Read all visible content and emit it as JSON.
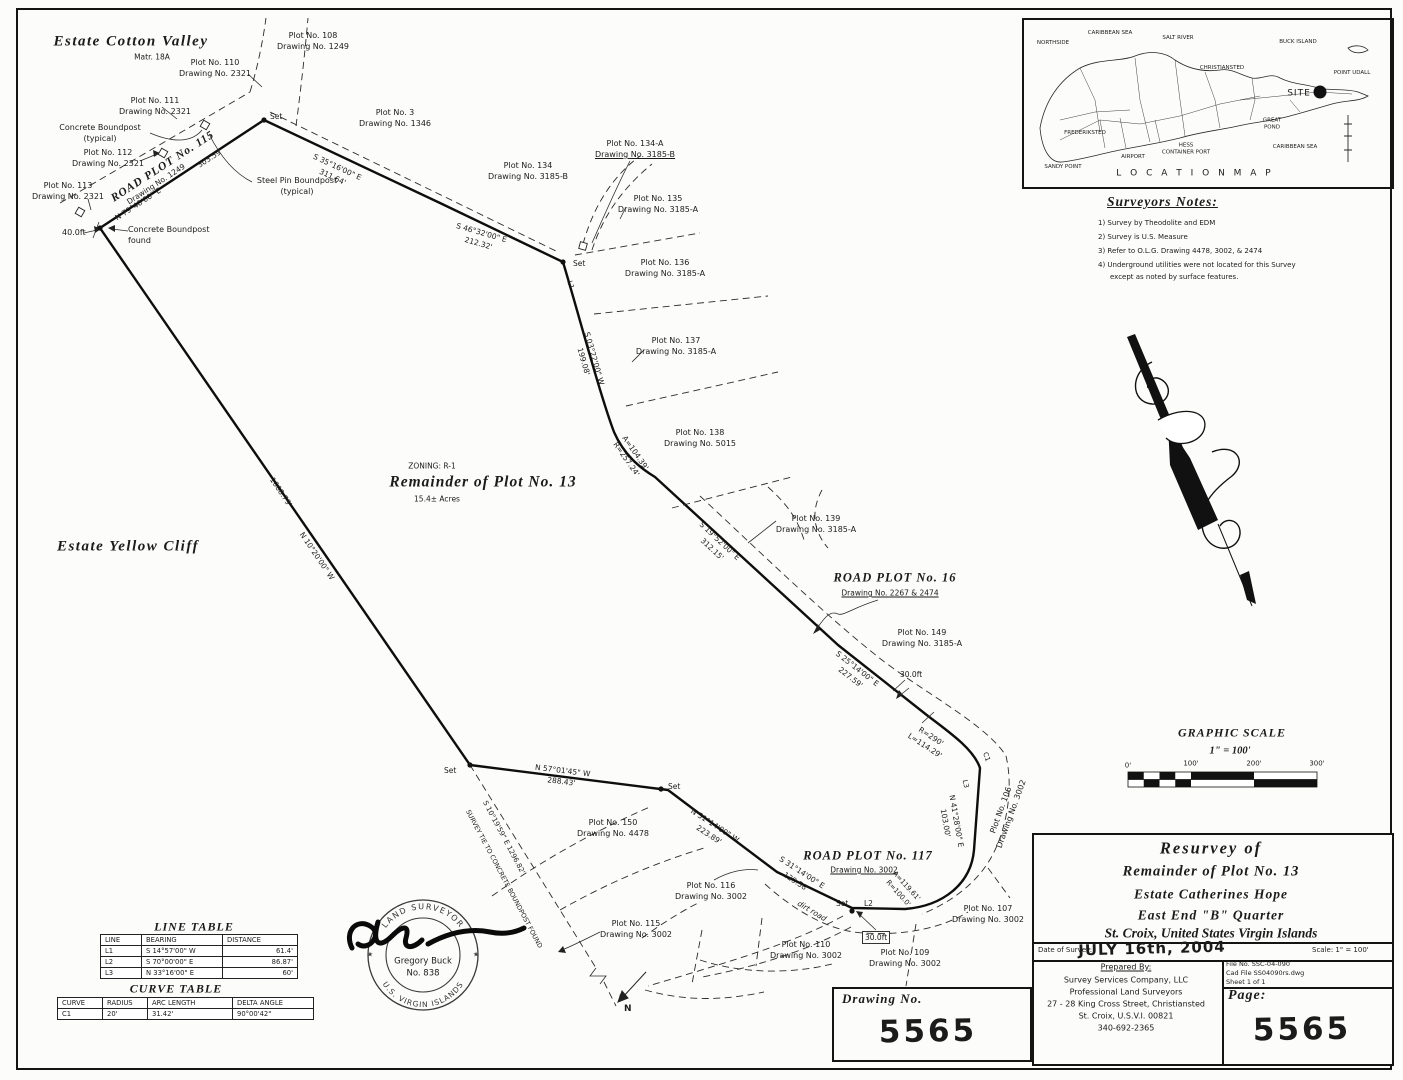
{
  "estates": {
    "cotton_valley": "Estate Cotton Valley",
    "cotton_valley_matr": "Matr. 18A",
    "yellow_cliff": "Estate Yellow Cliff"
  },
  "parcel": {
    "zoning": "ZONING: R-1",
    "title": "Remainder of Plot No. 13",
    "area": "15.4± Acres"
  },
  "plots": [
    {
      "name": "Plot No. 108",
      "drawing": "Drawing No. 1249"
    },
    {
      "name": "Plot No. 110",
      "drawing": "Drawing No. 2321"
    },
    {
      "name": "Plot No. 111",
      "drawing": "Drawing No. 2321"
    },
    {
      "name": "Plot No. 112",
      "drawing": "Drawing No. 2321"
    },
    {
      "name": "Plot No. 113",
      "drawing": "Drawing No. 2321"
    },
    {
      "name": "Plot No. 3",
      "drawing": "Drawing No. 1346"
    },
    {
      "name": "Plot No. 134",
      "drawing": "Drawing No. 3185-B"
    },
    {
      "name": "Plot No. 134-A",
      "drawing": "Drawing No. 3185-B"
    },
    {
      "name": "Plot No. 135",
      "drawing": "Drawing No. 3185-A"
    },
    {
      "name": "Plot No. 136",
      "drawing": "Drawing No. 3185-A"
    },
    {
      "name": "Plot No. 137",
      "drawing": "Drawing No. 3185-A"
    },
    {
      "name": "Plot No. 138",
      "drawing": "Drawing No. 5015"
    },
    {
      "name": "Plot No. 139",
      "drawing": "Drawing No. 3185-A"
    },
    {
      "name": "Plot No. 149",
      "drawing": "Drawing No. 3185-A"
    },
    {
      "name": "Plot No. 150",
      "drawing": "Drawing No. 4478"
    },
    {
      "name": "Plot No. 116",
      "drawing": "Drawing No. 3002"
    },
    {
      "name": "Plot No. 115",
      "drawing": "Drawing No. 3002"
    },
    {
      "name": "Plot No. 110",
      "drawing": "Drawing No. 3002"
    },
    {
      "name": "Plot No. 109",
      "drawing": "Drawing No. 3002"
    },
    {
      "name": "Plot No. 107",
      "drawing": "Drawing No. 3002"
    },
    {
      "name": "Plot No. 106",
      "drawing": "Drawing No. 3002"
    }
  ],
  "roads": [
    {
      "name": "ROAD PLOT No. 115",
      "drawing": "Drawing No. 1249"
    },
    {
      "name": "ROAD PLOT No. 16",
      "drawing": "Drawing No. 2267 & 2474"
    },
    {
      "name": "ROAD PLOT No. 117",
      "drawing": "Drawing No. 3002"
    }
  ],
  "bearings": [
    {
      "b": "N 79°40'00\" E",
      "d": "303.59'"
    },
    {
      "b": "S 35°16'00\" E",
      "d": "311.64'"
    },
    {
      "b": "S 46°32'00\" E",
      "d": "212.32'"
    },
    {
      "b": "S 03°22'00\" W",
      "d": "199.08'"
    },
    {
      "b": "A=104.39'",
      "d": "R=257.24'"
    },
    {
      "b": "S 19°52'00\" E",
      "d": "312.15'"
    },
    {
      "b": "S 25°14'00\" E",
      "d": "227.59'"
    },
    {
      "b": "R=290'",
      "d": "L=114.29'"
    },
    {
      "b": "N 41°28'00\" E",
      "d": "103.00'"
    },
    {
      "b": "A=119.61'",
      "d": "R=100.0'"
    },
    {
      "b": "S 31°14'00\" E",
      "d": "129.58'"
    },
    {
      "b": "N 31°14'00\" W",
      "d": "223.89'"
    },
    {
      "b": "N 57°01'45\" W",
      "d": "288.43'"
    },
    {
      "b": "N 10°20'00\" W",
      "d": "1008.79'"
    }
  ],
  "survey_tie": {
    "line1": "S 10°19'59\" E  1296.82'",
    "line2": "SURVEY TIE TO CONCRETE BOUNDPOST FOUND"
  },
  "annotations": {
    "set": "Set",
    "l1": "L1",
    "l2": "L2",
    "l3": "L3",
    "c1": "C1",
    "concrete_boundpost": "Concrete Boundpost",
    "typical": "(typical)",
    "steel_pin_boundpost": "Steel Pin Boundpost",
    "found": "found",
    "ft40": "40.0ft",
    "ft30": "30.0ft",
    "dirt_road": "dirt road",
    "north_letter": "N"
  },
  "location_map": {
    "title": "L O C A T I O N   M A P",
    "labels": {
      "northside": "NORTHSIDE",
      "caribbean_sea_n": "CARIBBEAN SEA",
      "salt_river": "SALT RIVER",
      "buck_island": "BUCK ISLAND",
      "christiansted": "CHRISTIANSTED",
      "point_udall": "POINT UDALL",
      "site": "SITE",
      "frederiksted": "FREDERIKSTED",
      "airport": "AIRPORT",
      "hess_1": "HESS",
      "hess_2": "CONTAINER PORT",
      "great_1": "GREAT",
      "great_2": "POND",
      "caribbean_sea_s": "CARIBBEAN SEA",
      "sandy_point": "SANDY POINT"
    }
  },
  "surveyors_notes": {
    "title": "Surveyors Notes:",
    "items": [
      "1) Survey by Theodolite and EDM",
      "2) Survey is U.S. Measure",
      "3) Refer to O.L.G. Drawing 4478, 3002, & 2474",
      "4) Underground utilities were not located for this Survey",
      "except as noted by surface features."
    ]
  },
  "graphic_scale": {
    "title": "GRAPHIC SCALE",
    "ratio": "1\" = 100'",
    "ticks": [
      "0'",
      "100'",
      "200'",
      "300'"
    ]
  },
  "line_table": {
    "title": "LINE TABLE",
    "headers": [
      "LINE",
      "BEARING",
      "DISTANCE"
    ],
    "rows": [
      [
        "L1",
        "S 14°57'00\" W",
        "61.4'"
      ],
      [
        "L2",
        "S 70°00'00\" E",
        "86.87'"
      ],
      [
        "L3",
        "N 33°16'00\" E",
        "60'"
      ]
    ]
  },
  "curve_table": {
    "title": "CURVE TABLE",
    "headers": [
      "CURVE",
      "RADIUS",
      "ARC LENGTH",
      "DELTA ANGLE"
    ],
    "rows": [
      [
        "C1",
        "20'",
        "31.42'",
        "90°00'42\""
      ]
    ]
  },
  "stamp": {
    "arc_top": "LAND SURVEYOR",
    "arc_bottom": "U.S. VIRGIN ISLANDS",
    "name": "Gregory Buck",
    "number": "No. 838",
    "star": "★"
  },
  "title_block": {
    "line1": "Resurvey of",
    "line2": "Remainder of Plot No. 13",
    "line3": "Estate Catherines Hope",
    "line4": "East End \"B\" Quarter",
    "line5": "St. Croix, United States Virgin Islands",
    "date_label": "Date of Survey:",
    "date_value": "JULY 16th, 2004",
    "scale": "Scale: 1\" = 100'",
    "prepared_by_label": "Prepared By:",
    "company": "Survey Services Company, LLC",
    "profession": "Professional Land Surveyors",
    "address1": "27 - 28 King Cross Street, Christiansted",
    "address2": "St. Croix, U.S.V.I. 00821",
    "phone": "340-692-2365",
    "file_no": "File No.  SSC-04-090",
    "cad_file": "Cad File SS04090rs.dwg",
    "sheet": "Sheet 1 of 1",
    "page_label": "Page:",
    "page_value": "5565"
  },
  "drawing_block": {
    "label": "Drawing No.",
    "value": "5565"
  }
}
